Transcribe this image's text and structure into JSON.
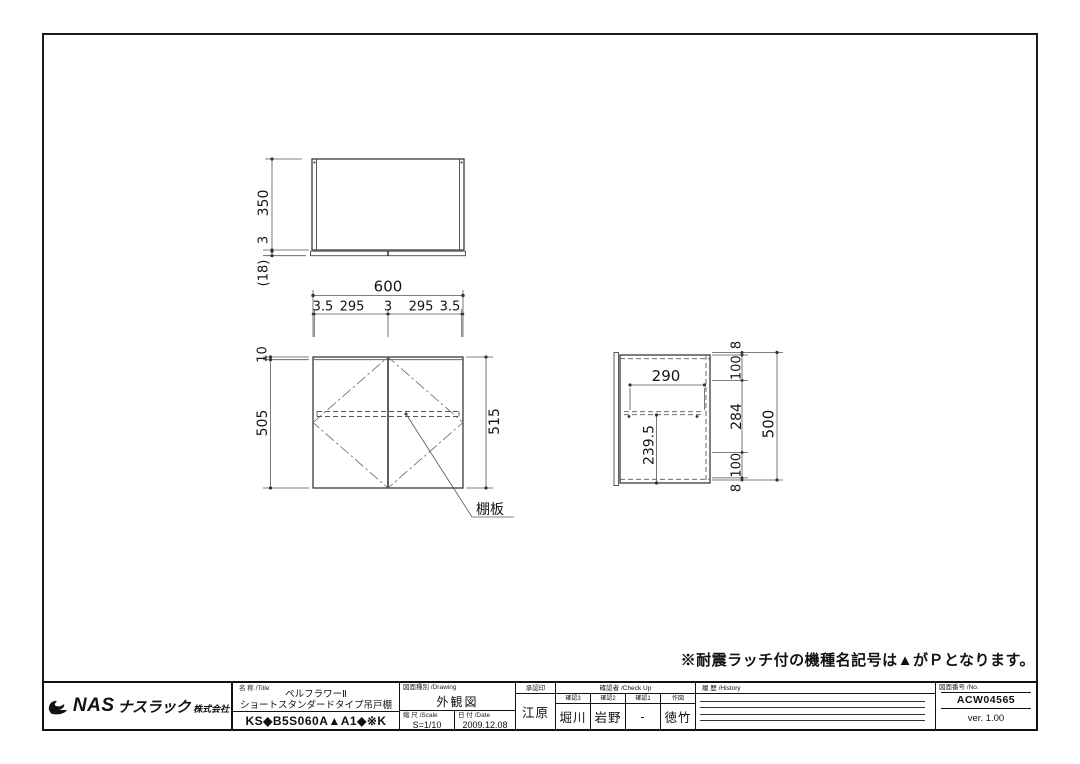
{
  "note": "※耐震ラッチ付の機種名記号は▲がＰとなります。",
  "views": {
    "top": {
      "depth": "350",
      "gap": "3",
      "door_thickness": "(18)"
    },
    "front": {
      "width": "600",
      "chain": [
        "3.5",
        "295",
        "3",
        "295",
        "3.5"
      ],
      "top_offset": "10",
      "body_height": "505",
      "overall_height": "515",
      "shelf_label": "棚板"
    },
    "side": {
      "shelf_depth": "290",
      "shelf_height": "239.5",
      "chain": [
        "8",
        "100",
        "284",
        "100",
        "8"
      ],
      "total_height": "500"
    }
  },
  "title_block": {
    "company": {
      "prefix": "NAS",
      "name": "ナスラック",
      "suffix": "株式会社"
    },
    "title_label": "名 称 /Title",
    "title_line1": "ペルフラワーⅡ",
    "title_line2": "ショートスタンダードタイプ吊戸棚",
    "model_code": "KS◆B5S060A▲A1◆※K",
    "drawing_label": "図面種別 /Drawing",
    "drawing_type": "外観図",
    "scale_label": "縮 尺 /Scale",
    "scale_value": "S=1/10",
    "date_label": "日 付 /Date",
    "date_value": "2009.12.08",
    "approval_label": "承認印",
    "approval_value": "江原",
    "check_label": "確認者 /Check Up",
    "checks": [
      {
        "label": "確認3",
        "value": "堀川"
      },
      {
        "label": "確認2",
        "value": "岩野"
      },
      {
        "label": "確認1",
        "value": "-"
      },
      {
        "label": "作図",
        "value": "徳竹"
      }
    ],
    "history_label": "履 歴 /History",
    "no_label": "図面番号 /No.",
    "no_value": "ACW04565",
    "version": "ver. 1.00"
  }
}
